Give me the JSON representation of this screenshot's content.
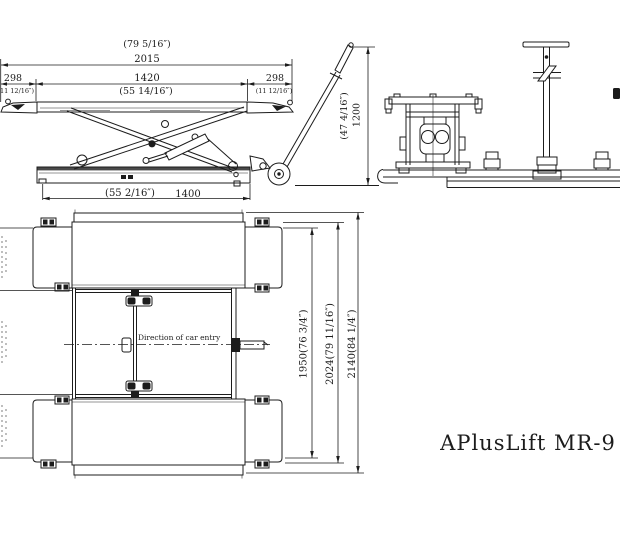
{
  "title": "APlusLift MR-9",
  "side": {
    "total_in": "(79 5/16″)",
    "total_mm": "2015",
    "left_mm": "298",
    "left_in": "(11 12/16″)",
    "mid_mm": "1420",
    "mid_in": "(55 14/16″)",
    "right_mm": "298",
    "right_in": "(11 12/16″)",
    "base_in": "(55 2/16″)",
    "base_mm": "1400",
    "height_in": "(47 4/16″)",
    "height_mm": "1200"
  },
  "top": {
    "entry": "Direction of car entry",
    "w1": "1950(76 3/4″)",
    "w2": "2024(79 11/16″)",
    "w3": "2140(84 1/4″)"
  },
  "colors": {
    "line": "#1c1c1c",
    "background": "#ffffff"
  }
}
